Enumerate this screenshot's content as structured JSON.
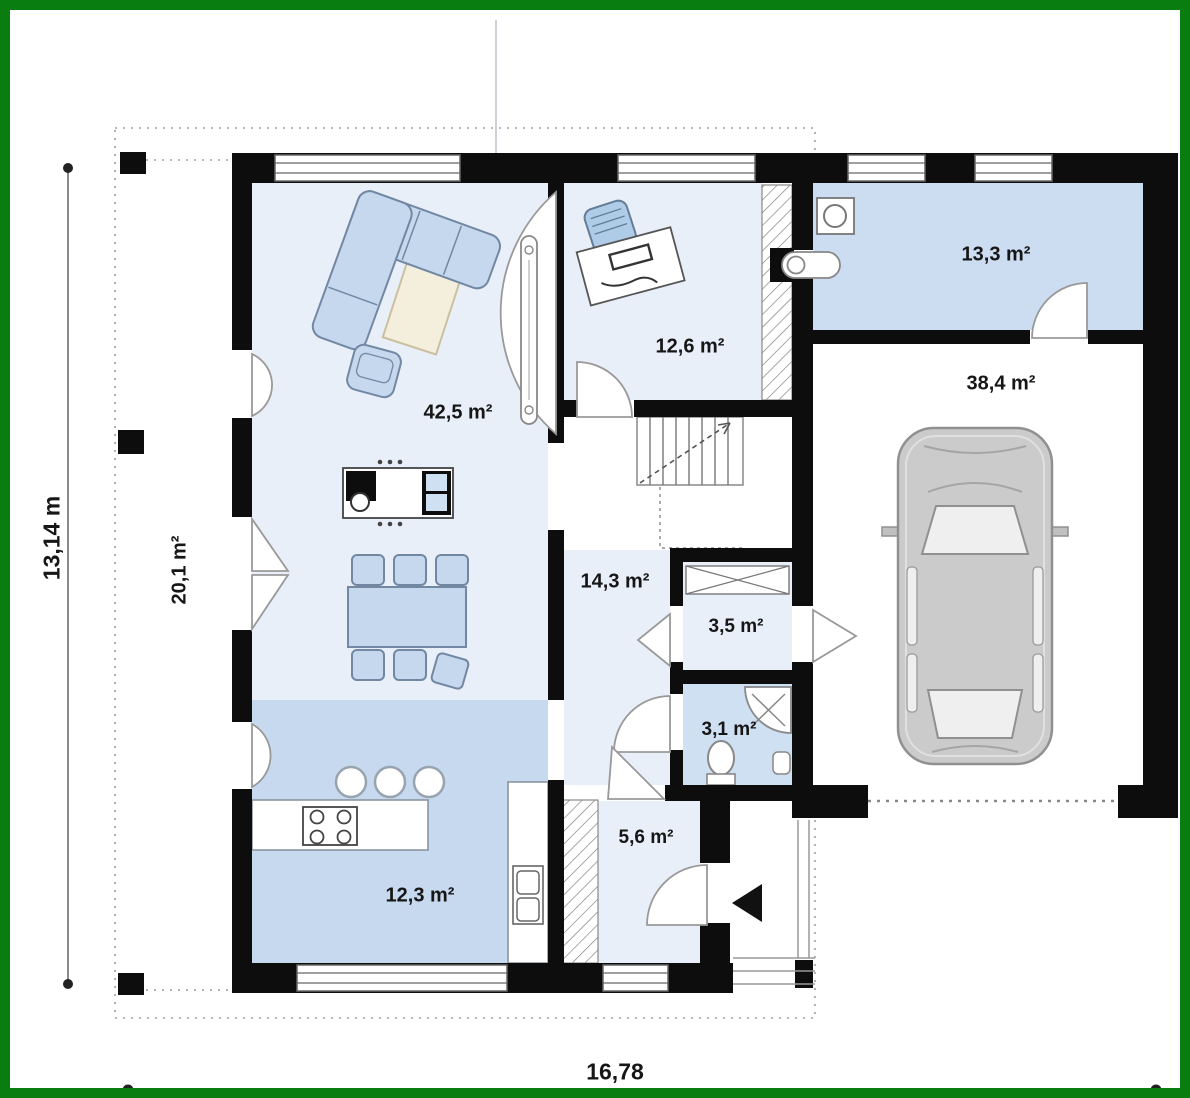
{
  "rooms": {
    "living": {
      "label": "42,5 m²"
    },
    "office": {
      "label": "12,6 m²"
    },
    "utility": {
      "label": "13,3 m²"
    },
    "garage": {
      "label": "38,4 m²"
    },
    "hall": {
      "label": "14,3 m²"
    },
    "closet": {
      "label": "3,5 m²"
    },
    "bathroom": {
      "label": "3,1 m²"
    },
    "entrance": {
      "label": "5,6 m²"
    },
    "kitchen": {
      "label": "12,3 m²"
    },
    "terrace": {
      "label": "20,1 m²"
    }
  },
  "dimensions": {
    "height_label": "13,14 m",
    "width_label": "16,78"
  },
  "colors": {
    "frame_green": "#0a7d10",
    "wall": "#0d0d0d",
    "room_light_blue": "#e9eff8",
    "room_medium_blue": "#ccddf1",
    "kitchen_blue": "#c7d9ef",
    "bath_blue": "#cfe0f3",
    "furniture_blue": "#c5d8ee",
    "car_gray": "#cbcbcb",
    "rug_beige": "#f4eedd"
  },
  "icons": [
    "corner-sofa-icon",
    "armchair-icon",
    "rug-icon",
    "media-unit-icon",
    "dining-table-icon",
    "chair-icon",
    "kitchen-counter-icon",
    "stove-icon",
    "sink-icon",
    "bar-stool-icon",
    "desk-icon",
    "office-chair-icon",
    "stairs-icon",
    "wardrobe-icon",
    "closet-cabinet-icon",
    "washing-machine-icon",
    "water-heater-icon",
    "shower-icon",
    "toilet-icon",
    "washbasin-icon",
    "car-icon",
    "entrance-arrow-icon",
    "door-swing-icon",
    "window-icon",
    "dimension-line-icon"
  ]
}
